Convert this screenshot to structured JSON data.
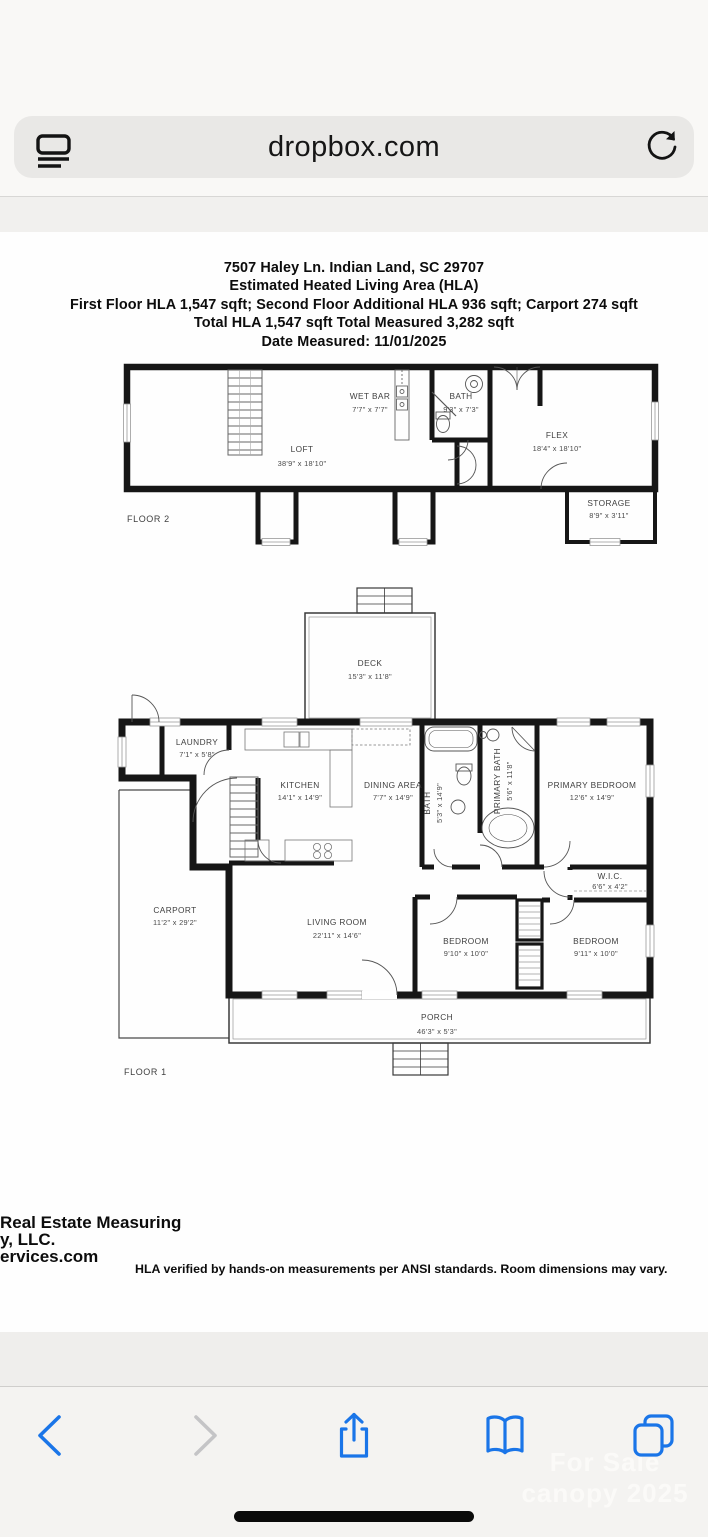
{
  "status_bar": {
    "time": "7:14",
    "network": "LTE",
    "battery_level": "80"
  },
  "url_bar": {
    "url": "dropbox.com"
  },
  "document": {
    "header_lines": [
      "7507 Haley Ln. Indian Land, SC 29707",
      "Estimated Heated Living Area (HLA)",
      "First Floor HLA 1,547 sqft; Second Floor Additional HLA 936 sqft; Carport 274 sqft",
      "Total HLA 1,547 sqft  Total Measured 3,282 sqft",
      "Date Measured: 11/01/2025"
    ],
    "floor2": {
      "name": "FLOOR 2",
      "rooms": [
        {
          "label": "LOFT",
          "dims": "38'9\" x 18'10\""
        },
        {
          "label": "WET BAR",
          "dims": "7'7\" x 7'7\""
        },
        {
          "label": "BATH",
          "dims": "9'3\" x 7'3\""
        },
        {
          "label": "FLEX",
          "dims": "18'4\" x 18'10\""
        },
        {
          "label": "STORAGE",
          "dims": "8'9\" x 3'11\""
        }
      ]
    },
    "floor1": {
      "name": "FLOOR 1",
      "rooms": [
        {
          "label": "DECK",
          "dims": "15'3\" x 11'8\""
        },
        {
          "label": "LAUNDRY",
          "dims": "7'1\" x 5'8\""
        },
        {
          "label": "KITCHEN",
          "dims": "14'1\" x 14'9\""
        },
        {
          "label": "DINING AREA",
          "dims": "7'7\" x 14'9\""
        },
        {
          "label": "BATH",
          "dims": "5'3\" x 14'9\""
        },
        {
          "label": "PRIMARY BATH",
          "dims": "5'6\" x 11'8\""
        },
        {
          "label": "PRIMARY BEDROOM",
          "dims": "12'6\" x 14'9\""
        },
        {
          "label": "W.I.C.",
          "dims": "6'6\" x 4'2\""
        },
        {
          "label": "CARPORT",
          "dims": "11'2\" x 29'2\""
        },
        {
          "label": "LIVING ROOM",
          "dims": "22'11\" x 14'6\""
        },
        {
          "label": "BEDROOM",
          "dims": "9'10\" x 10'0\""
        },
        {
          "label": "BEDROOM",
          "dims": "9'11\" x 10'0\""
        },
        {
          "label": "PORCH",
          "dims": "46'3\" x 5'3\""
        }
      ]
    },
    "footer": {
      "company_lines": [
        "Real Estate Measuring",
        "y, LLC.",
        "ervices.com"
      ],
      "disclaimer": "HLA verified by hands-on measurements per ANSI standards. Room dimensions may vary."
    },
    "watermark_lines": [
      "For Sale",
      "canopy 2025"
    ]
  },
  "colors": {
    "accent_blue": "#1a75e8",
    "battery_green": "#35c759",
    "chrome_bg": "#f9f8f6",
    "toolbar_bg": "#f4f3f1"
  }
}
